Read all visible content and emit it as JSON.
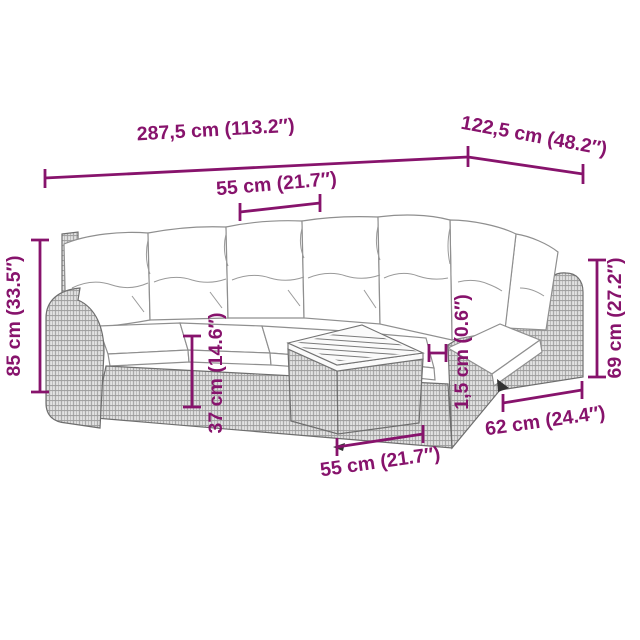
{
  "illustration": {
    "subject": "garden corner sofa set with back cushions, seat cushions and wooden-top rattan table",
    "style": "line drawing with woven rattan texture"
  },
  "dimensions": {
    "total_length": "287,5 cm (113.2″)",
    "return_length": "122,5 cm (48.2″)",
    "seat_width": "55 cm (21.7″)",
    "total_height": "85 cm (33.5″)",
    "seat_height": "37 cm (14.6″)",
    "tabletop_thickness": "1,5 cm (0.6″)",
    "side_height": "69 cm (27.2″)",
    "side_depth": "62 cm (24.4″)",
    "table_width": "55 cm (21.7″)"
  },
  "colors": {
    "accent": "#87136C",
    "rattan_light": "#e7e7e7",
    "rattan_dark": "#9c9c9c",
    "cushion": "#ffffff",
    "background": "#ffffff"
  }
}
